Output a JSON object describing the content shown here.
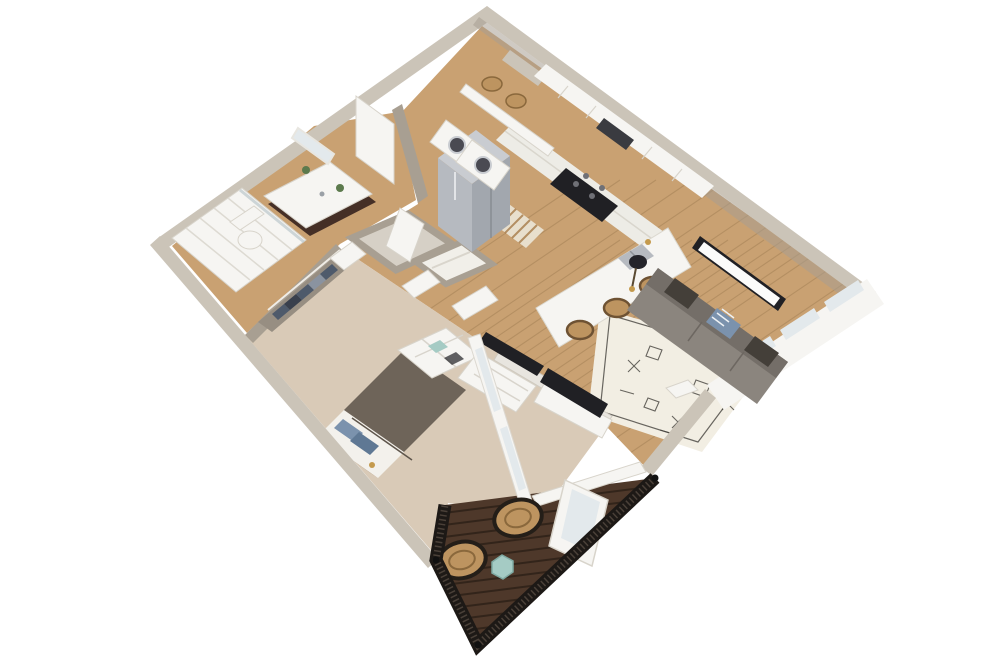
{
  "scene": {
    "description": "3D isometric cutaway rendering of a one-bedroom apartment floor plan with balcony, viewed from above on a white background",
    "background": "#ffffff"
  },
  "palette": {
    "bg": "#ffffff",
    "wallTop": "#cbc4b8",
    "wallFace": "#a89f92",
    "wallDark": "#978e82",
    "wood": "#c9a172",
    "woodLine": "#9c7a50",
    "carpet": "#d9cab7",
    "deck": "#4e382a",
    "deckLine": "#2e2118",
    "railing": "#1d1916",
    "white": "#f6f5f2",
    "counter": "#edece6",
    "glass": "#e3e9ec",
    "steel": "#b6bac0",
    "steelTop": "#c9ccd1",
    "steelSide": "#a2a7ae",
    "black": "#202024",
    "vanity": "#452f26",
    "sofa": "#8b857e",
    "sofaBack": "#746e68",
    "pillowDark": "#443f39",
    "denim": "#7b92ad",
    "rug": "#f2eee3",
    "rugInk": "#45423d",
    "rattan": "#bd9460",
    "rattanDark": "#6e5233",
    "teal": "#a5cbc4",
    "green": "#5c7a4d",
    "gold": "#c49a4d",
    "headboard": "#8a6848",
    "clothes": "#4e5a6b"
  },
  "rooms": {
    "bathroom": {
      "name": "bathroom",
      "items": [
        "walk-in-shower",
        "toilet",
        "dark-wood-vanity",
        "mirror",
        "potted-plants"
      ]
    },
    "laundry_nook": {
      "name": "laundry-nook",
      "items": [
        "washer",
        "dryer",
        "wall-shelf",
        "wicker-baskets"
      ]
    },
    "kitchen": {
      "name": "kitchen",
      "items": [
        "stainless-fridge",
        "range",
        "microwave",
        "upper-cabinets",
        "base-cabinets",
        "island-with-sink",
        "bar-stools",
        "striped-runner-rug"
      ]
    },
    "living_room": {
      "name": "living-room",
      "items": [
        "gray-sofa",
        "throw-pillows",
        "floor-lamp",
        "wall-mounted-tv",
        "media-console-tv",
        "patterned-area-rug",
        "tray-table",
        "triple-window"
      ]
    },
    "bedroom": {
      "name": "bedroom",
      "items": [
        "bed",
        "blue-pillows",
        "wood-headboard",
        "wall-sconces",
        "cube-shelf",
        "dresser-with-tv",
        "closet-with-clothes",
        "windows"
      ]
    },
    "hall": {
      "name": "hall",
      "items": [
        "utility-closet-water-heater",
        "linen-closet",
        "doors"
      ]
    },
    "balcony": {
      "name": "balcony",
      "items": [
        "dark-wood-decking",
        "metal-railing",
        "two-wicker-chairs",
        "teal-side-table",
        "french-door"
      ]
    }
  }
}
